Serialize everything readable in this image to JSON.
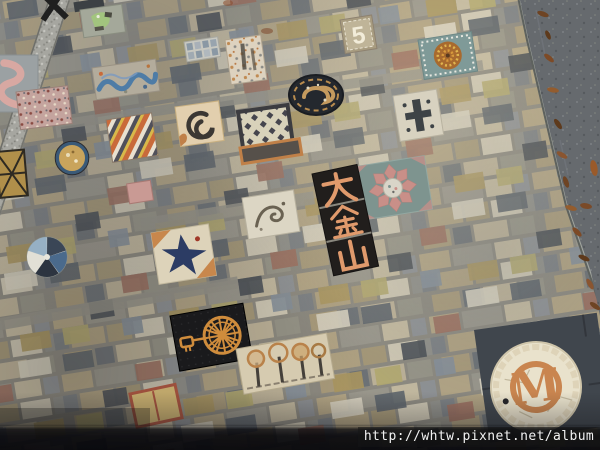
{
  "meta": {
    "type": "photograph",
    "subject": "Overhead photo of a decorative mosaic stone pavement with embedded art tiles, a granite expansion strip, an asphalt road edge with fallen leaves, and a shadow band at the bottom"
  },
  "watermark": {
    "url_text": "http://whtw.pixnet.net/album",
    "bar_color": "rgba(22,22,22,0.55)",
    "text_color": "#f2f2f2"
  },
  "tiles": {
    "chinese_tile": {
      "characters": "大金山",
      "char_list": [
        "大",
        "金",
        "山"
      ],
      "glyph_color": "#e09a6c",
      "background": "#211e1c"
    },
    "monogram_medallion": {
      "letter": "M",
      "letter_color": "#c9854f",
      "background": "#e9e2cc"
    },
    "number_tile": {
      "digit": "5",
      "digit_color": "#f2ecd9"
    },
    "features": [
      {
        "name": "black-x-mark",
        "description": "black X shaped mark cut by top edge",
        "position": "top-left"
      },
      {
        "name": "green-paint-tile",
        "description": "gray tile with light green painted figure",
        "position": "top-left"
      },
      {
        "name": "pink-s-mosaic",
        "description": "pink serpentine S curve mosaic",
        "position": "left edge"
      },
      {
        "name": "speckled-pink-tile",
        "description": "pink terrazzo speckled tile",
        "position": "left"
      },
      {
        "name": "blue-wave-mosaic",
        "description": "blue wave line over pebble tile",
        "position": "upper-left"
      },
      {
        "name": "striped-tile",
        "description": "diagonal orange/cream/slate striped tile",
        "position": "left-middle"
      },
      {
        "name": "gold-lattice-tile",
        "description": "gold tile with black lattice",
        "position": "left edge"
      },
      {
        "name": "amber-glass-medallion",
        "description": "round amber mosaic with dark blue ring",
        "position": "left-middle"
      },
      {
        "name": "compass-pinwheel-mosaic",
        "description": "round blue/white pinwheel mosaic",
        "position": "left-middle"
      },
      {
        "name": "speckled-marble-tile",
        "description": "white marble tile with orange specks",
        "position": "top-middle"
      },
      {
        "name": "blue-grid-tile",
        "description": "small grid of blue-gray squares",
        "position": "top-middle"
      },
      {
        "name": "dark-spiral-emblem",
        "description": "dark round emblem with tan swirl",
        "position": "top-middle"
      },
      {
        "name": "sun-dot-mosaic",
        "description": "teal tile with orange/yellow dotted sun circle",
        "position": "top-right"
      },
      {
        "name": "cross-tile",
        "description": "light tile with dark cross figure",
        "position": "upper-right"
      },
      {
        "name": "brush-swirl-tile",
        "description": "cream tile with dark brush spiral",
        "position": "center-left"
      },
      {
        "name": "checker-diamond-tile",
        "description": "dark framed tile with diamond grid",
        "position": "center"
      },
      {
        "name": "lotus-flower-medallion",
        "description": "teal tile with pink eight petal flower",
        "position": "center-right"
      },
      {
        "name": "chinese-character-tile",
        "description": "black vertical tile with three orange characters",
        "position": "center"
      },
      {
        "name": "dragon-sketch-tile",
        "description": "white tile with faint curling figure",
        "position": "center"
      },
      {
        "name": "origami-crane-tile",
        "description": "cream tile with dark blue angular crane star and orange corners",
        "position": "center-left"
      },
      {
        "name": "spinning-wheel-mosaic",
        "description": "black tile with orange spoked wheel and key",
        "position": "bottom-left"
      },
      {
        "name": "trees-mosaic",
        "description": "cream tile with row of dark trees",
        "position": "bottom-center"
      },
      {
        "name": "red-framed-tile",
        "description": "tan tile with red frame",
        "position": "bottom-left"
      },
      {
        "name": "m-monogram-medallion",
        "description": "round cream mosaic with orange M monogram on dark slate",
        "position": "bottom-right"
      },
      {
        "name": "granite-expansion-strip",
        "description": "speckled granite strip running diagonally top to bottom",
        "position": "left"
      },
      {
        "name": "asphalt-road",
        "description": "dark asphalt corner beyond light curb stones",
        "position": "top-right"
      },
      {
        "name": "fallen-leaves",
        "description": "brown dried leaves along the gutter",
        "position": "right"
      },
      {
        "name": "shadow-band",
        "description": "dark shadow band across the bottom",
        "position": "bottom"
      }
    ]
  },
  "palette": {
    "mortar": "#8d8a80",
    "brick_tan": "#b3a585",
    "brick_beige": "#c4baa0",
    "brick_gray": "#9a978c",
    "brick_slate": "#6d7276",
    "granite": "#a6a6a0",
    "asphalt": "#666a6e",
    "curb": "#a0a49e",
    "shadow": "#0a0a0e",
    "leaf_brown": "#7d4a26",
    "accent_orange": "#c9854f",
    "accent_teal": "#7f9a98",
    "accent_pink": "#c98f88"
  }
}
